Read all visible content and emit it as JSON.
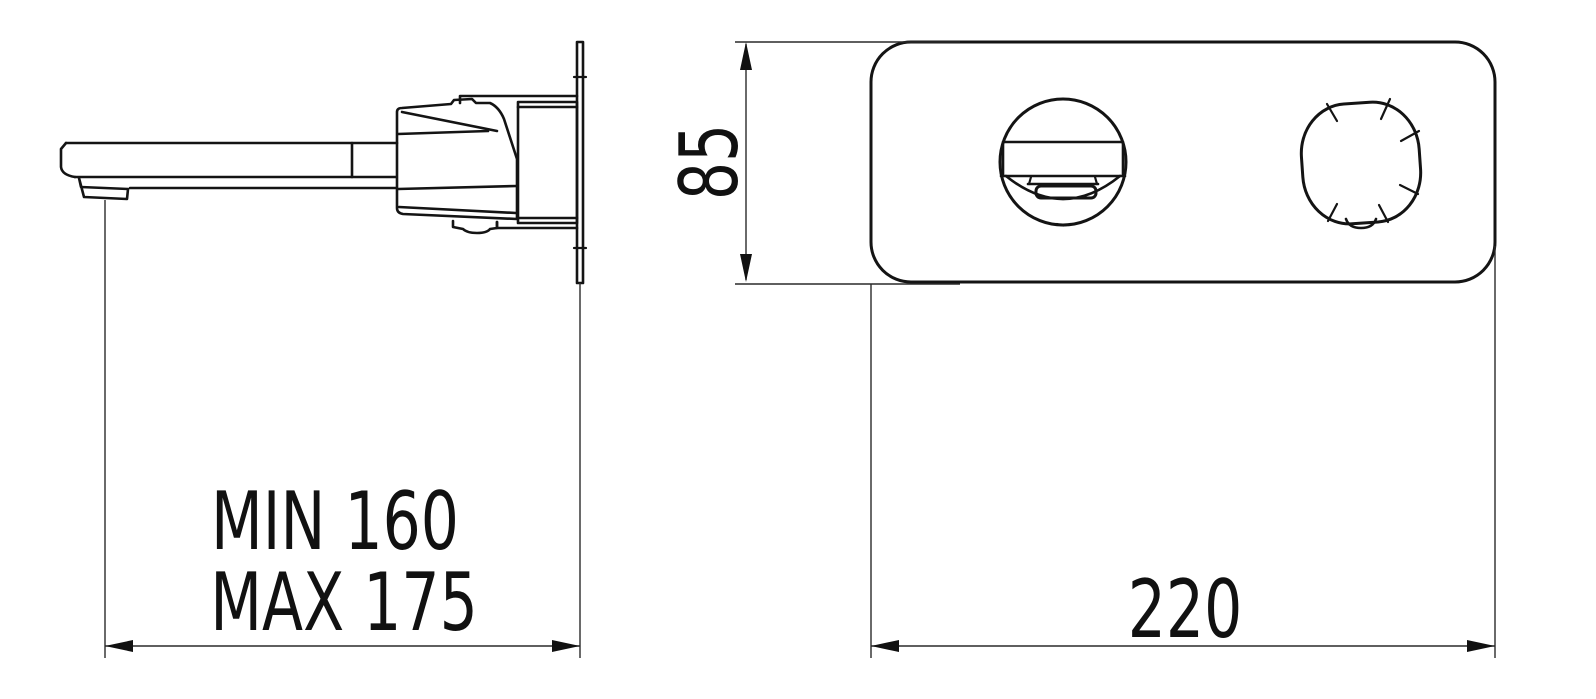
{
  "drawing_title": "wall-mounted-basin-mixer-dimension-drawing",
  "colors": {
    "background": "#ffffff",
    "line": "#141414",
    "text": "#111111"
  },
  "dimensions": {
    "projection_min": "MIN 160",
    "projection_max": "MAX 175",
    "plate_height": "85",
    "plate_width": "220"
  }
}
